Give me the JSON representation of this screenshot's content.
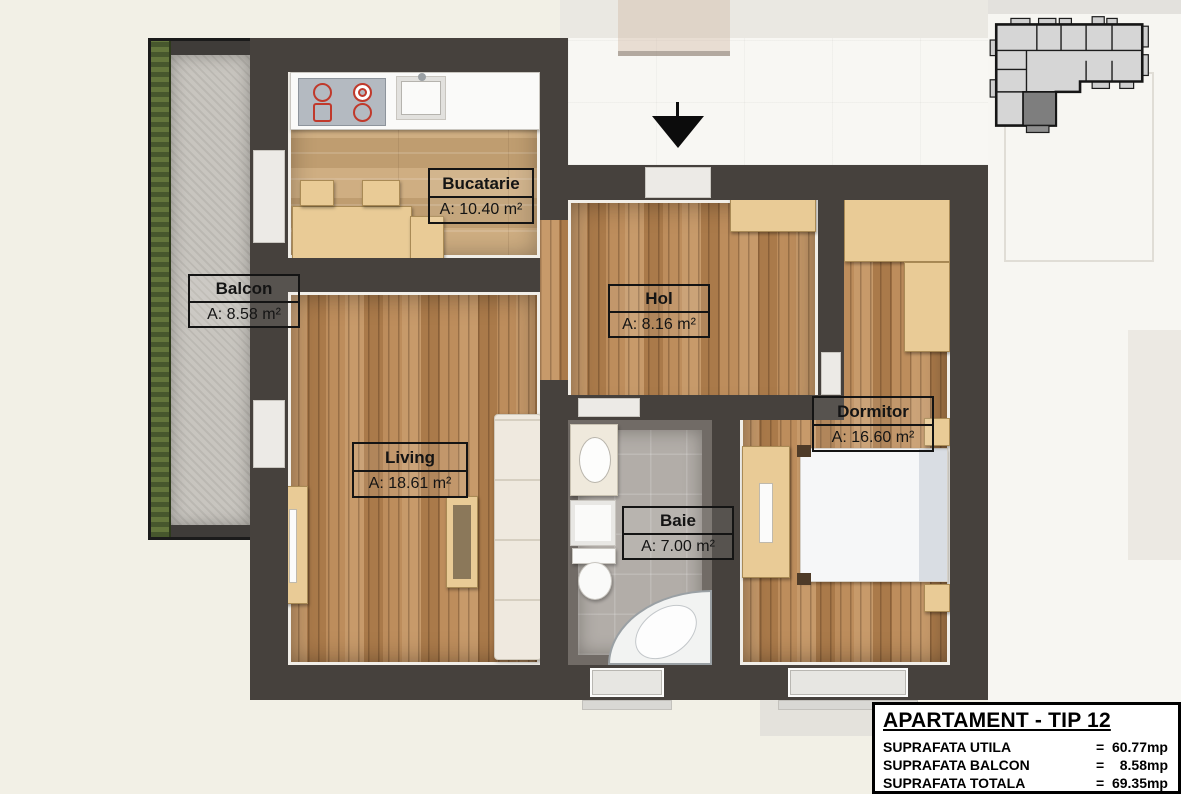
{
  "rooms": [
    {
      "name": "Bucatarie",
      "area": "A: 10.40 m²"
    },
    {
      "name": "Balcon",
      "area": "A: 8.58 m²"
    },
    {
      "name": "Hol",
      "area": "A: 8.16 m²"
    },
    {
      "name": "Living",
      "area": "A: 18.61 m²"
    },
    {
      "name": "Baie",
      "area": "A: 7.00 m²"
    },
    {
      "name": "Dormitor",
      "area": "A: 16.60 m²"
    }
  ],
  "title_block": {
    "title": "APARTAMENT - TIP 12",
    "rows": [
      {
        "label": "SUPRAFATA UTILA",
        "eq": "=",
        "value": "60.77mp"
      },
      {
        "label": "SUPRAFATA BALCON",
        "eq": "=",
        "value": "8.58mp"
      },
      {
        "label": "SUPRAFATA TOTALA",
        "eq": "=",
        "value": "69.35mp"
      }
    ]
  },
  "colors": {
    "wall": "#46413d",
    "wood_floor": "#b08052",
    "kitchen_floor": "#c7a678",
    "bath_floor": "#b2ada8",
    "balcony_floor": "#c8c5bf",
    "burner_accent": "#c0392b",
    "minimap_highlight": "#7e7e7e"
  },
  "icons": {
    "entrance_arrow": "down-arrow marking apartment entrance",
    "building_minimap": "building locator with highlighted unit"
  }
}
